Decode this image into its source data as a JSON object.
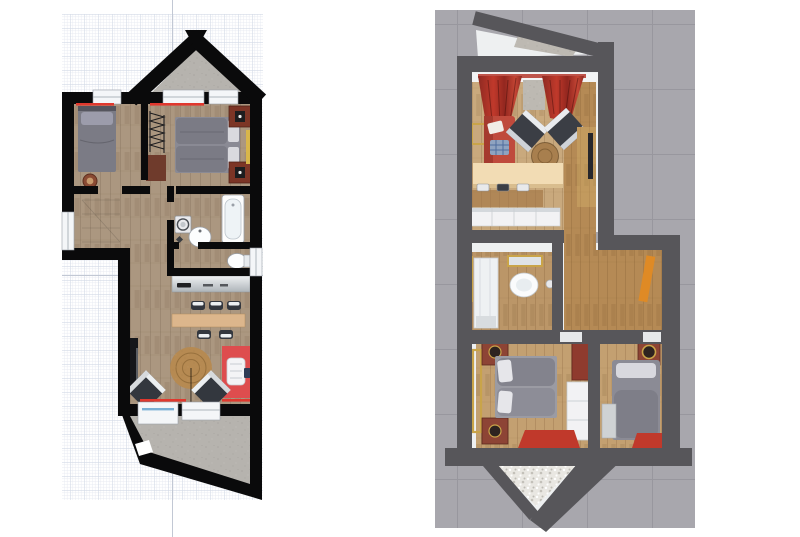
{
  "meta": {
    "description": "Two views of the same small attic apartment floor plan, side by side",
    "left_view_label": "2D top-down floor plan on graph paper",
    "right_view_label": "3D rendered top-down floor plan on gray tiled ground"
  },
  "palette": {
    "page_bg": "#ffffff",
    "grid_minor": "#e6e9f1",
    "grid_major": "#d3dae6",
    "axis_line": "#c2c8d4",
    "wall_2d": "#0a0a0b",
    "wood_2d": "#ab9780",
    "concrete": "#b6b3ae",
    "window_white": "#f4f6f8",
    "door_glass_blue": "#7ab0d4",
    "accent_red": "#e0382e",
    "bed_gray": "#7b7b85",
    "pillow_gray": "#9c9cab",
    "rug_red": "#de4d4e",
    "bar_tan": "#dcb68c",
    "jute": "#b68a52",
    "nightstand_brown": "#7c3526",
    "rug_brown": "#6f3b2c",
    "chair_dark": "#33373e",
    "counter_gray": "#c6cacd",
    "bg_3d": "#a8a7ad",
    "wall_3d": "#57565a",
    "interior_3d": "#eef0f1",
    "wood_living": "#c9a97d",
    "wood_hall": "#b58a55",
    "wood_bed": "#c3a071",
    "wood_bath": "#bb9668",
    "cream_counter": "#f2dcb4",
    "cabinet_wood": "#c29a5e",
    "curtain_red": "#b4372c",
    "sofa_red": "#bf4a3c",
    "door_orange": "#df8a25",
    "gold": "#c9a449",
    "bed_gray_3d": "#8b8b95",
    "white_furn": "#f2f2f4",
    "bay_gravel": "#bdb9b2"
  },
  "left_plan": {
    "view": "2D top-down floor plan on graph paper",
    "rooms": [
      {
        "name": "bedroom-left",
        "furniture": [
          "single-bed",
          "round-stool",
          "window",
          "red-curtain-line"
        ]
      },
      {
        "name": "bedroom-right",
        "furniture": [
          "double-bed",
          "nightstand-top",
          "nightstand-bottom",
          "radiator",
          "brown-rug",
          "wardrobe-strip",
          "red-curtain-line"
        ]
      },
      {
        "name": "roof-bay-balcony",
        "furniture": [
          "concrete-floor",
          "bay-window-left",
          "bay-window-right"
        ]
      },
      {
        "name": "hallway",
        "furniture": [
          "stair-outline"
        ]
      },
      {
        "name": "bathroom",
        "furniture": [
          "bathtub",
          "washing-machine",
          "washbasin"
        ]
      },
      {
        "name": "wc",
        "furniture": [
          "toilet",
          "window"
        ]
      },
      {
        "name": "kitchen",
        "furniture": [
          "counter-with-sink"
        ]
      },
      {
        "name": "living-room",
        "furniture": [
          "bar-stools-row",
          "bar-table",
          "bar-stools-pair",
          "tv-sideboard",
          "round-jute-rug",
          "dark-armchair-left",
          "dark-armchair-right",
          "red-rug",
          "white-armchair",
          "remote-tray",
          "terrace-door",
          "terrace-window",
          "red-curtain-lines"
        ]
      },
      {
        "name": "terrace",
        "furniture": [
          "concrete-floor",
          "wall-opening"
        ]
      }
    ]
  },
  "right_plan": {
    "view": "3D rendered top-down floor plan on gray tiled ground",
    "rooms": [
      {
        "name": "roof-bay-balcony",
        "furniture": [
          "gravel-floor"
        ]
      },
      {
        "name": "living-room",
        "furniture": [
          "red-curtain-left",
          "red-curtain-right",
          "red-sofa",
          "white-pillow",
          "plaid-pillow",
          "gold-picture-frame",
          "dark-armchair-left",
          "dark-armchair-right",
          "round-coffee-table",
          "cream-bar-counter",
          "tv-cabinet",
          "tv-screen"
        ]
      },
      {
        "name": "kitchen",
        "furniture": [
          "dining-table",
          "dining-chairs",
          "white-cabinet-row"
        ]
      },
      {
        "name": "bathroom",
        "furniture": [
          "gold-mirror",
          "washbasin",
          "shower-cabin",
          "gold-picture",
          "round-stool"
        ]
      },
      {
        "name": "hallway",
        "furniture": [
          "orange-door"
        ]
      },
      {
        "name": "bedroom-double",
        "furniture": [
          "double-bed",
          "nightstand-top",
          "nightstand-bottom",
          "floor-mirror",
          "red-chest",
          "white-wardrobe",
          "red-rug"
        ]
      },
      {
        "name": "bedroom-single",
        "furniture": [
          "single-bed",
          "nightstand",
          "gray-desk",
          "red-rug"
        ]
      },
      {
        "name": "terrace",
        "furniture": [
          "fluffy-white-rug"
        ]
      }
    ]
  }
}
